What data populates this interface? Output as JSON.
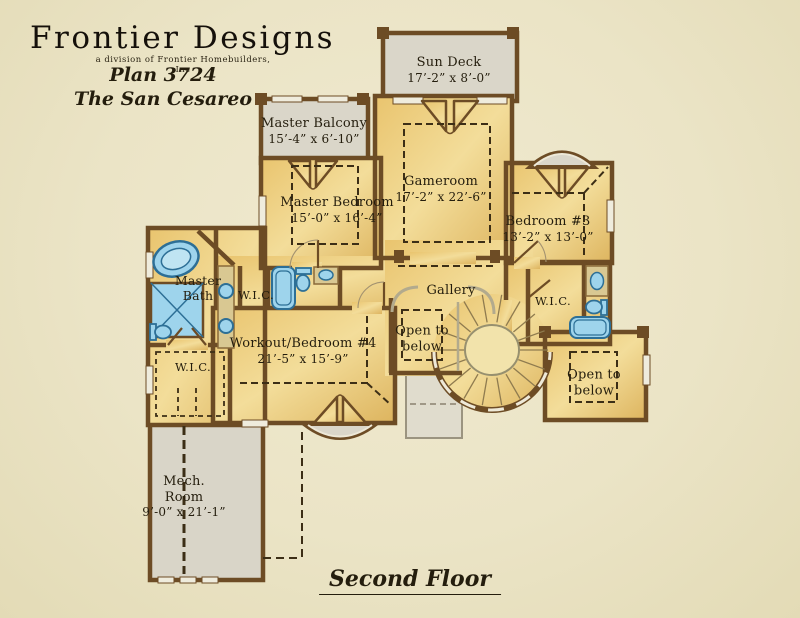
{
  "header": {
    "brand": "Frontier Designs",
    "brand_sub": "a division of Frontier Homebuilders, Inc",
    "plan_number": "Plan 3724",
    "plan_name": "The San Cesareo"
  },
  "floor_label": "Second Floor",
  "rooms": {
    "sun_deck": {
      "name": "Sun Deck",
      "dims": "17’-2” x 8’-0”"
    },
    "master_balcony": {
      "name": "Master Balcony",
      "dims": "15’-4” x 6’-10”"
    },
    "master_bedroom": {
      "name": "Master Bedroom",
      "dims": "15’-0” x 16’-4”"
    },
    "gameroom": {
      "name": "Gameroom",
      "dims": "17’-2” x 22’-6”"
    },
    "bedroom_3": {
      "name": "Bedroom #3",
      "dims": "13’-2” x 13’-0”"
    },
    "master_bath": {
      "line1": "Master",
      "line2": "Bath"
    },
    "wic_master": {
      "name": "W.I.C."
    },
    "wic_lower": {
      "name": "W.I.C."
    },
    "wic_right": {
      "name": "W.I.C."
    },
    "gallery": {
      "name": "Gallery"
    },
    "open_to_below_left": {
      "line1": "Open to",
      "line2": "below"
    },
    "open_to_below_right": {
      "line1": "Open to",
      "line2": "below"
    },
    "workout_bedroom_4": {
      "name": "Workout/Bedroom #4",
      "dims": "21’-5” x 15’-9”"
    },
    "mech_room": {
      "line1": "Mech.",
      "line2": "Room",
      "dims": "9’-0” x 21’-1”"
    }
  },
  "colors": {
    "background": "#ebe4c6",
    "wall_brown": "#6d4c25",
    "room_gold": "#eccb79",
    "deck_gray": "#dad6c9",
    "fixture_blue": "#9ed4ec",
    "text": "#241d0d"
  }
}
